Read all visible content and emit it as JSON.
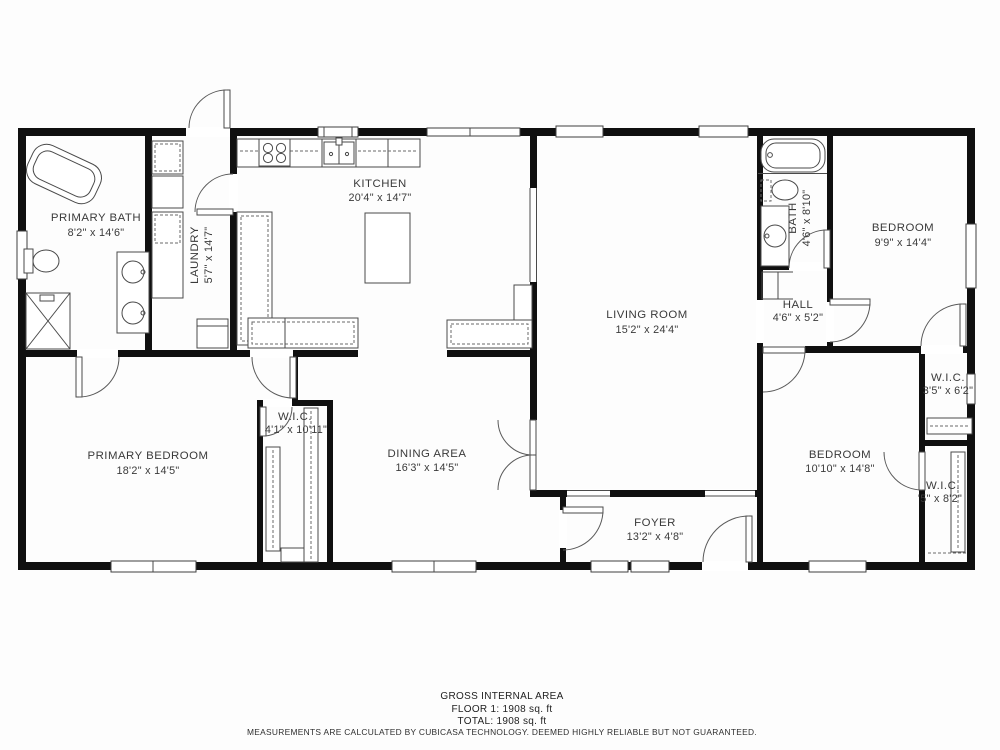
{
  "rooms": {
    "primary_bath": {
      "name": "PRIMARY BATH",
      "dims": "8'2\" x 14'6\""
    },
    "laundry": {
      "name": "LAUNDRY",
      "dims": "5'7\" x 14'7\""
    },
    "kitchen": {
      "name": "KITCHEN",
      "dims": "20'4\" x 14'7\""
    },
    "living_room": {
      "name": "LIVING ROOM",
      "dims": "15'2\" x 24'4\""
    },
    "bath": {
      "name": "BATH",
      "dims": "4'6\" x 8'10\""
    },
    "hall": {
      "name": "HALL",
      "dims": "4'6\" x 5'2\""
    },
    "bedroom_top": {
      "name": "BEDROOM",
      "dims": "9'9\" x 14'4\""
    },
    "wic_top": {
      "name": "W.I.C.",
      "dims": "3'5\" x 6'2\""
    },
    "bedroom_bottom": {
      "name": "BEDROOM",
      "dims": "10'10\" x 14'8\""
    },
    "wic_bottom": {
      "name": "W.I.C.",
      "dims": "'5\" x 8'2\""
    },
    "primary_bedroom": {
      "name": "PRIMARY BEDROOM",
      "dims": "18'2\" x 14'5\""
    },
    "wic_primary": {
      "name": "W.I.C.",
      "dims": "4'1\" x 10'11\""
    },
    "dining": {
      "name": "DINING AREA",
      "dims": "16'3\" x 14'5\""
    },
    "foyer": {
      "name": "FOYER",
      "dims": "13'2\" x 4'8\""
    }
  },
  "footer": {
    "title": "GROSS INTERNAL AREA",
    "floor": "FLOOR 1: 1908 sq. ft",
    "total": "TOTAL: 1908 sq. ft",
    "disclaimer": "MEASUREMENTS ARE CALCULATED BY CUBICASA TECHNOLOGY. DEEMED HIGHLY RELIABLE BUT NOT GUARANTEED."
  },
  "colors": {
    "wall": "#101010",
    "line": "#4a4a4a",
    "text": "#3a3a3a"
  }
}
